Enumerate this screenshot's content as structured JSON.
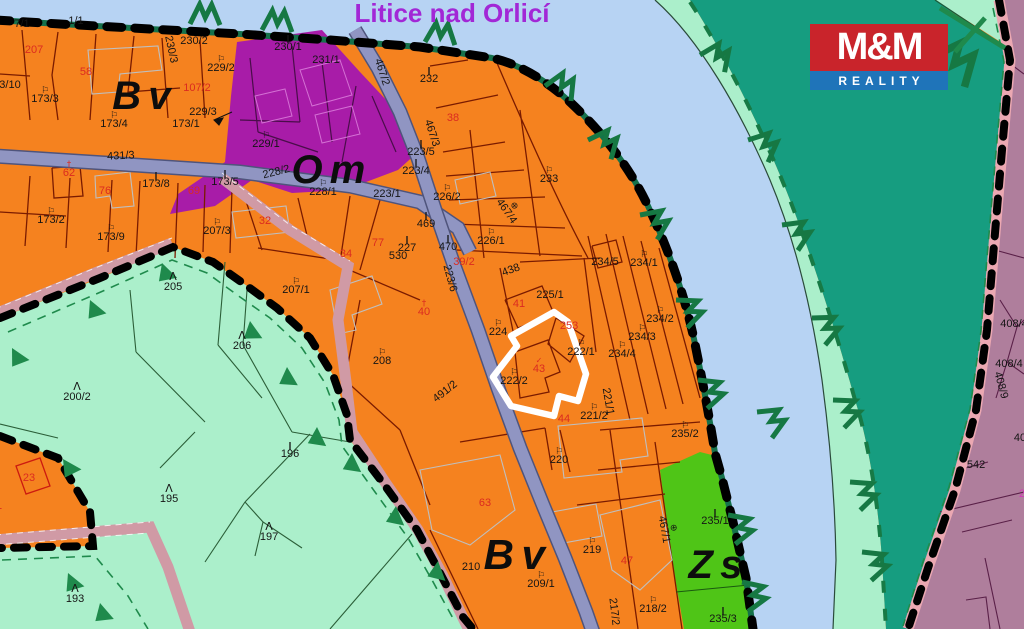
{
  "map": {
    "title": "Litice nad Orlicí",
    "zone_labels": [
      {
        "t": "Bv",
        "x": 145,
        "y": 109,
        "fs": 40
      },
      {
        "t": "Om",
        "x": 332,
        "y": 183,
        "fs": 40
      },
      {
        "t": "Bv",
        "x": 518,
        "y": 569,
        "fs": 42
      },
      {
        "t": "Zs",
        "x": 719,
        "y": 578,
        "fs": 40
      }
    ],
    "highlight": {
      "outlined_parcels": [
        "43",
        "222/2"
      ]
    },
    "parcel_labels": [
      {
        "t": "7/1",
        "x": 22,
        "y": 27
      },
      {
        "t": "1/1",
        "x": 76,
        "y": 24
      },
      {
        "t": "207",
        "x": 34,
        "y": 53,
        "c": "r"
      },
      {
        "t": "58",
        "x": 86,
        "y": 75,
        "c": "r"
      },
      {
        "t": "230/3",
        "x": 168,
        "y": 50,
        "rot": 78
      },
      {
        "t": "230/2",
        "x": 194,
        "y": 44
      },
      {
        "t": "229/2",
        "x": 221,
        "y": 71,
        "s": "g"
      },
      {
        "t": "107/2",
        "x": 197,
        "y": 91,
        "c": "r"
      },
      {
        "t": "229/3",
        "x": 203,
        "y": 115
      },
      {
        "t": "3/10",
        "x": 10,
        "y": 88
      },
      {
        "t": "173/3",
        "x": 45,
        "y": 102,
        "s": "g"
      },
      {
        "t": "173/4",
        "x": 114,
        "y": 127,
        "s": "g"
      },
      {
        "t": "173/1",
        "x": 186,
        "y": 127
      },
      {
        "t": "230/1",
        "x": 288,
        "y": 50,
        "s": "m"
      },
      {
        "t": "231/1",
        "x": 326,
        "y": 63
      },
      {
        "t": "467/2",
        "x": 379,
        "y": 73,
        "rot": 72
      },
      {
        "t": "232",
        "x": 429,
        "y": 82,
        "s": "m"
      },
      {
        "t": "229/1",
        "x": 266,
        "y": 147,
        "s": "g"
      },
      {
        "t": "228/2",
        "x": 277,
        "y": 175,
        "rot": -14
      },
      {
        "t": "228/1",
        "x": 323,
        "y": 195,
        "s": "g"
      },
      {
        "t": "223/1",
        "x": 387,
        "y": 197
      },
      {
        "t": "467/3",
        "x": 429,
        "y": 134,
        "rot": 72
      },
      {
        "t": "38",
        "x": 453,
        "y": 121,
        "c": "r"
      },
      {
        "t": "223/5",
        "x": 421,
        "y": 155,
        "s": "m"
      },
      {
        "t": "223/4",
        "x": 416,
        "y": 174,
        "s": "m"
      },
      {
        "t": "226/2",
        "x": 447,
        "y": 200,
        "s": "g"
      },
      {
        "t": "469",
        "x": 426,
        "y": 227,
        "s": "m"
      },
      {
        "t": "470",
        "x": 448,
        "y": 250,
        "s": "m"
      },
      {
        "t": "39/2",
        "x": 464,
        "y": 265,
        "c": "r"
      },
      {
        "t": "226/1",
        "x": 491,
        "y": 244,
        "s": "g"
      },
      {
        "t": "438",
        "x": 512,
        "y": 273,
        "rot": -20
      },
      {
        "t": "467/4",
        "x": 504,
        "y": 213,
        "rot": 55,
        "s": "o"
      },
      {
        "t": "233",
        "x": 549,
        "y": 182,
        "s": "g"
      },
      {
        "t": "225/1",
        "x": 550,
        "y": 298
      },
      {
        "t": "41",
        "x": 519,
        "y": 307,
        "c": "r"
      },
      {
        "t": "224",
        "x": 498,
        "y": 335,
        "s": "g"
      },
      {
        "t": "253",
        "x": 569,
        "y": 329,
        "c": "r"
      },
      {
        "t": "43",
        "x": 539,
        "y": 372,
        "c": "r",
        "s": "v"
      },
      {
        "t": "222/2",
        "x": 514,
        "y": 384,
        "s": "g"
      },
      {
        "t": "222/1",
        "x": 581,
        "y": 355,
        "s": "g"
      },
      {
        "t": "234/5",
        "x": 605,
        "y": 265
      },
      {
        "t": "234/1",
        "x": 644,
        "y": 266,
        "s": "g"
      },
      {
        "t": "234/2",
        "x": 660,
        "y": 322,
        "s": "g"
      },
      {
        "t": "234/3",
        "x": 642,
        "y": 340,
        "s": "g"
      },
      {
        "t": "234/4",
        "x": 622,
        "y": 357,
        "s": "g"
      },
      {
        "t": "221/2",
        "x": 594,
        "y": 419,
        "s": "g"
      },
      {
        "t": "44",
        "x": 564,
        "y": 422,
        "c": "r"
      },
      {
        "t": "221/1",
        "x": 605,
        "y": 402,
        "rot": 80
      },
      {
        "t": "235/2",
        "x": 685,
        "y": 437,
        "s": "g"
      },
      {
        "t": "220",
        "x": 559,
        "y": 463,
        "s": "g"
      },
      {
        "t": "219",
        "x": 592,
        "y": 553,
        "s": "g"
      },
      {
        "t": "47",
        "x": 627,
        "y": 564,
        "c": "r"
      },
      {
        "t": "63",
        "x": 485,
        "y": 506,
        "c": "r"
      },
      {
        "t": "209/1",
        "x": 541,
        "y": 587,
        "s": "g"
      },
      {
        "t": "218/2",
        "x": 653,
        "y": 612,
        "s": "g"
      },
      {
        "t": "217/2",
        "x": 611,
        "y": 612,
        "rot": 83
      },
      {
        "t": "467/1",
        "x": 661,
        "y": 530,
        "rot": 80,
        "s": "o"
      },
      {
        "t": "235/1",
        "x": 715,
        "y": 524,
        "s": "m"
      },
      {
        "t": "235/3",
        "x": 723,
        "y": 622,
        "s": "m"
      },
      {
        "t": "210",
        "x": 471,
        "y": 570
      },
      {
        "t": "431/3",
        "x": 121,
        "y": 159,
        "rot": -3
      },
      {
        "t": "62",
        "x": 69,
        "y": 176,
        "c": "r",
        "s": "x"
      },
      {
        "t": "76",
        "x": 105,
        "y": 194,
        "c": "r"
      },
      {
        "t": "173/8",
        "x": 156,
        "y": 187,
        "s": "m"
      },
      {
        "t": "69",
        "x": 194,
        "y": 194,
        "c": "r"
      },
      {
        "t": "173/5",
        "x": 225,
        "y": 185,
        "s": "m"
      },
      {
        "t": "173/2",
        "x": 51,
        "y": 223,
        "s": "g"
      },
      {
        "t": "173/9",
        "x": 111,
        "y": 240,
        "s": "g"
      },
      {
        "t": "207/3",
        "x": 217,
        "y": 234,
        "s": "g"
      },
      {
        "t": "32",
        "x": 265,
        "y": 224,
        "c": "r"
      },
      {
        "t": "34",
        "x": 346,
        "y": 257,
        "c": "r"
      },
      {
        "t": "77",
        "x": 378,
        "y": 246,
        "c": "r"
      },
      {
        "t": "227",
        "x": 407,
        "y": 251,
        "s": "m"
      },
      {
        "t": "530",
        "x": 398,
        "y": 259
      },
      {
        "t": "40",
        "x": 424,
        "y": 315,
        "c": "r",
        "s": "x"
      },
      {
        "t": "208",
        "x": 382,
        "y": 364,
        "s": "g"
      },
      {
        "t": "207/1",
        "x": 296,
        "y": 293,
        "s": "g"
      },
      {
        "t": "491/2",
        "x": 447,
        "y": 394,
        "rot": -38
      },
      {
        "t": "223/6",
        "x": 447,
        "y": 279,
        "rot": 75
      },
      {
        "t": "205",
        "x": 173,
        "y": 290,
        "s": "t"
      },
      {
        "t": "206",
        "x": 242,
        "y": 349,
        "s": "t"
      },
      {
        "t": "200/2",
        "x": 77,
        "y": 400,
        "s": "t"
      },
      {
        "t": "196",
        "x": 290,
        "y": 457,
        "s": "m"
      },
      {
        "t": "195",
        "x": 169,
        "y": 502,
        "s": "t"
      },
      {
        "t": "197",
        "x": 269,
        "y": 540,
        "s": "t"
      },
      {
        "t": "193",
        "x": 75,
        "y": 602,
        "s": "t"
      },
      {
        "t": "23",
        "x": 29,
        "y": 481,
        "c": "r"
      },
      {
        "t": "21",
        "x": -4,
        "y": 509,
        "c": "r"
      },
      {
        "t": "408/4",
        "x": 1014,
        "y": 327
      },
      {
        "t": "408/4",
        "x": 1009,
        "y": 367
      },
      {
        "t": "408/9",
        "x": 998,
        "y": 386,
        "rot": 75
      },
      {
        "t": "542",
        "x": 976,
        "y": 468
      },
      {
        "t": "40",
        "x": 1020,
        "y": 441
      },
      {
        "t": "2",
        "x": 1022,
        "y": 497,
        "c": "m"
      }
    ]
  },
  "logo": {
    "top": "M&M",
    "bottom": "REALITY"
  },
  "colors": {
    "orange_bv": "#F5821F",
    "purple_om": "#A81CA8",
    "mint": "#ABEFCB",
    "teal": "#169D80",
    "green_zs": "#4FC517",
    "river": "#B7D3F3",
    "mauve": "#AF7E9C",
    "pink_band": "#EBA8B2",
    "road_gray": "#9095C2",
    "road_pink": "#D09AA5",
    "boundary": "#000000",
    "bank_green": "#15714B",
    "symbol_green": "#1F8A4C",
    "highlight": "#FFFFFF",
    "title": "#A227D6",
    "logo_red": "#C9242B",
    "logo_blue": "#1F74B9",
    "label_black": "#151515",
    "label_red": "#DB2B20",
    "label_magenta": "#D238B8"
  }
}
